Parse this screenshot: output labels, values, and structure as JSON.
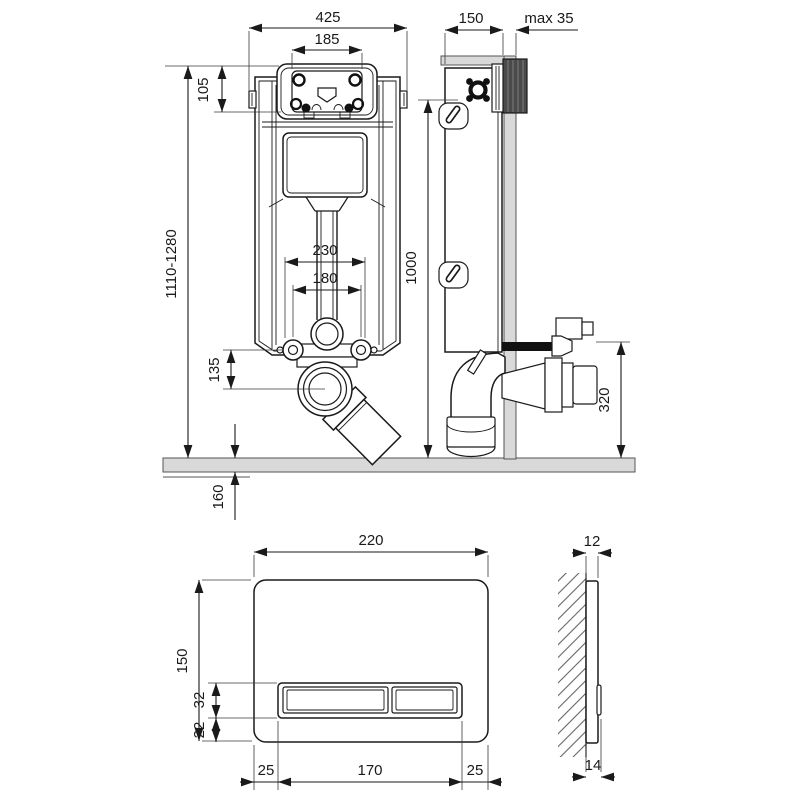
{
  "drawing": {
    "frame_front": {
      "width": "425",
      "opening_width": "185",
      "opening_height": "105",
      "height_range": "1110-1280",
      "outer_spacing": "230",
      "bolt_spacing": "180",
      "outlet_drop": "135",
      "floor_depth": "160"
    },
    "frame_side": {
      "depth": "150",
      "wall_allowance": "max 35",
      "fixing_height": "1000",
      "outlet_height": "320"
    },
    "plate_front": {
      "width": "220",
      "height": "150",
      "button_height": "32",
      "button_bottom": "22",
      "margin_left": "25",
      "button_span": "170",
      "margin_right": "25"
    },
    "plate_side": {
      "thickness": "12",
      "total_depth": "14"
    }
  }
}
